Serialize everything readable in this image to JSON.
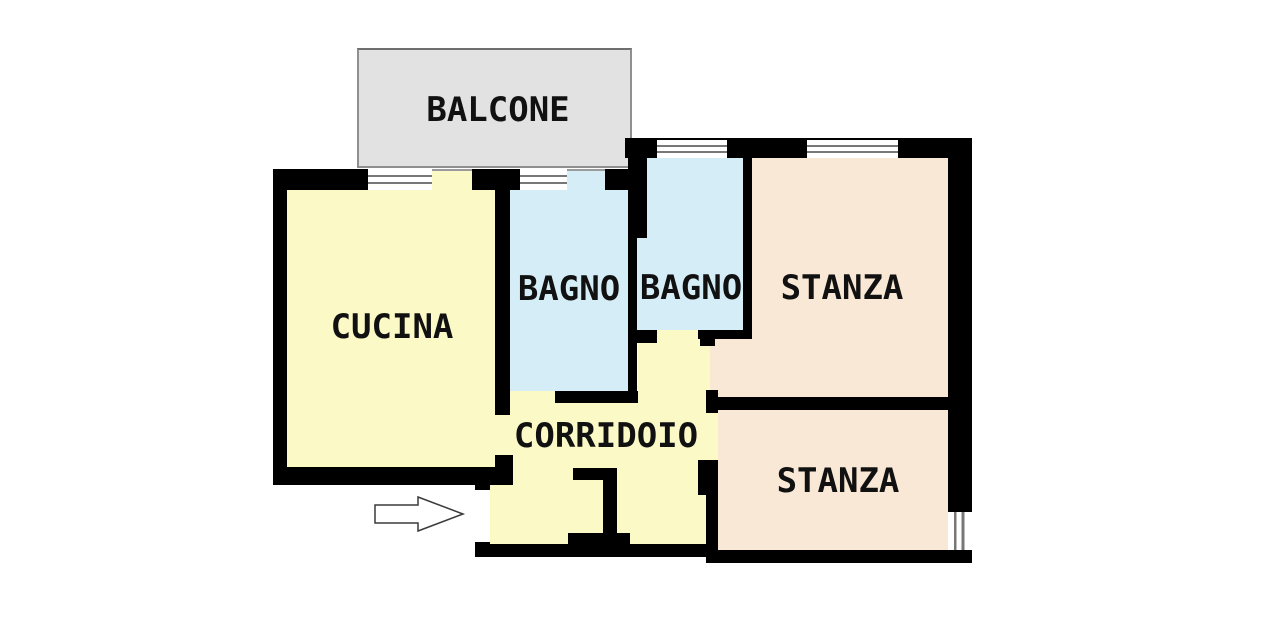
{
  "floor_plan": {
    "rooms": {
      "balcone": {
        "label": "BALCONE"
      },
      "cucina": {
        "label": "CUCINA"
      },
      "bagno_1": {
        "label": "BAGNO"
      },
      "bagno_2": {
        "label": "BAGNO"
      },
      "stanza_1": {
        "label": "STANZA"
      },
      "stanza_2": {
        "label": "STANZA"
      },
      "corridoio": {
        "label": "CORRIDOIO"
      }
    },
    "colors": {
      "wall": "#000000",
      "kitchen_corridor_fill": "#fbf9c6",
      "bathroom_fill": "#d5edf7",
      "bedroom_fill": "#fae8d6",
      "balcony_fill": "#e2e2e2",
      "balcony_border": "#8f8f8f",
      "window_line": "#777777",
      "background": "#ffffff"
    },
    "entrance": {
      "indicator": "arrow",
      "direction": "right"
    }
  }
}
